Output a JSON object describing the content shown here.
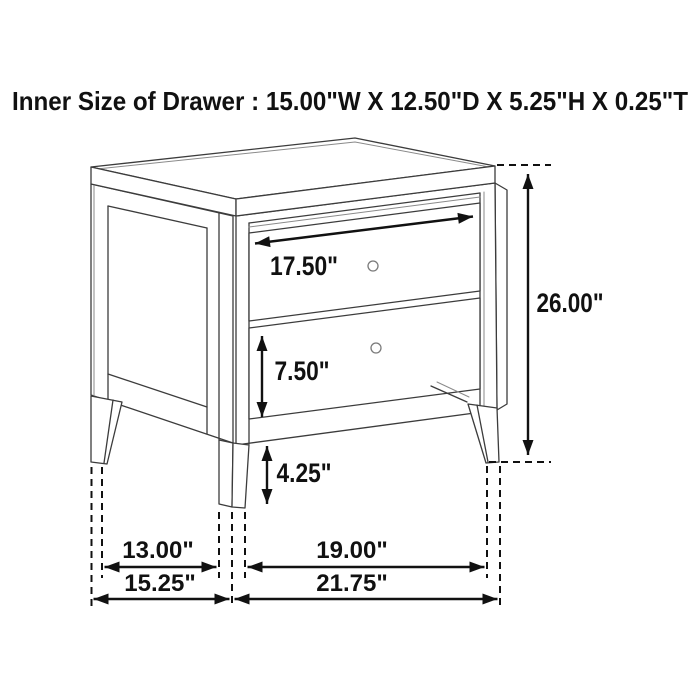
{
  "title": "Inner Size of Drawer : 15.00\"W X 12.50\"D X 5.25\"H X 0.25\"T",
  "figure": {
    "description": "Black-and-white line drawing of a two-drawer nightstand shown in perspective with dimension arrows",
    "labels": {
      "drawer_front_width": "17.50\"",
      "bottom_drawer_height": "7.50\"",
      "leg_height": "4.25\"",
      "overall_height": "26.00\"",
      "inner_depth_between_legs": "13.00\"",
      "overall_depth": "15.25\"",
      "inner_width_between_legs": "19.00\"",
      "overall_width": "21.75\""
    },
    "colors": {
      "background": "#ffffff",
      "furniture_line": "#3c3c3c",
      "detail_line": "#8a8a8a",
      "dimension_line": "#111111",
      "text": "#111111"
    }
  }
}
